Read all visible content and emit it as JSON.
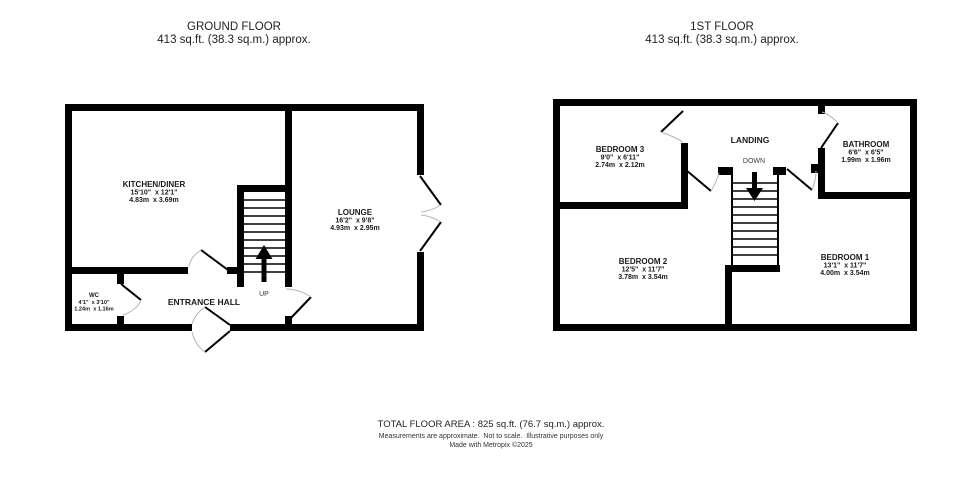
{
  "ground_floor": {
    "title": "GROUND FLOOR",
    "area_label": "413 sq.ft. (38.3 sq.m.) approx.",
    "stair_direction": "UP",
    "rooms": {
      "kitchen_diner": {
        "name": "KITCHEN/DINER",
        "imperial": "15'10\"  x 12'1\"",
        "metric": "4.83m  x 3.69m"
      },
      "lounge": {
        "name": "LOUNGE",
        "imperial": "16'2\"  x 9'8\"",
        "metric": "4.93m  x 2.95m"
      },
      "wc": {
        "name": "WC",
        "imperial": "4'1\"  x 3'10\"",
        "metric": "1.24m  x 1.16m"
      },
      "entrance_hall": {
        "name": "ENTRANCE HALL"
      }
    }
  },
  "first_floor": {
    "title": "1ST FLOOR",
    "area_label": "413 sq.ft. (38.3 sq.m.) approx.",
    "stair_direction": "DOWN",
    "rooms": {
      "bedroom_3": {
        "name": "BEDROOM 3",
        "imperial": "9'0\"  x 6'11\"",
        "metric": "2.74m  x 2.12m"
      },
      "landing": {
        "name": "LANDING"
      },
      "bathroom": {
        "name": "BATHROOM",
        "imperial": "6'6\"  x 6'5\"",
        "metric": "1.99m  x 1.96m"
      },
      "bedroom_2": {
        "name": "BEDROOM 2",
        "imperial": "12'5\"  x 11'7\"",
        "metric": "3.78m  x 3.54m"
      },
      "bedroom_1": {
        "name": "BEDROOM 1",
        "imperial": "13'1\"  x 11'7\"",
        "metric": "4.00m  x 3.54m"
      }
    }
  },
  "footer": {
    "total_area": "TOTAL FLOOR AREA : 825 sq.ft. (76.7 sq.m.) approx.",
    "disclaimer": "Measurements are approximate.  Not to scale.  Illustrative purposes only",
    "credit": "Made with Metropix ©2025"
  }
}
